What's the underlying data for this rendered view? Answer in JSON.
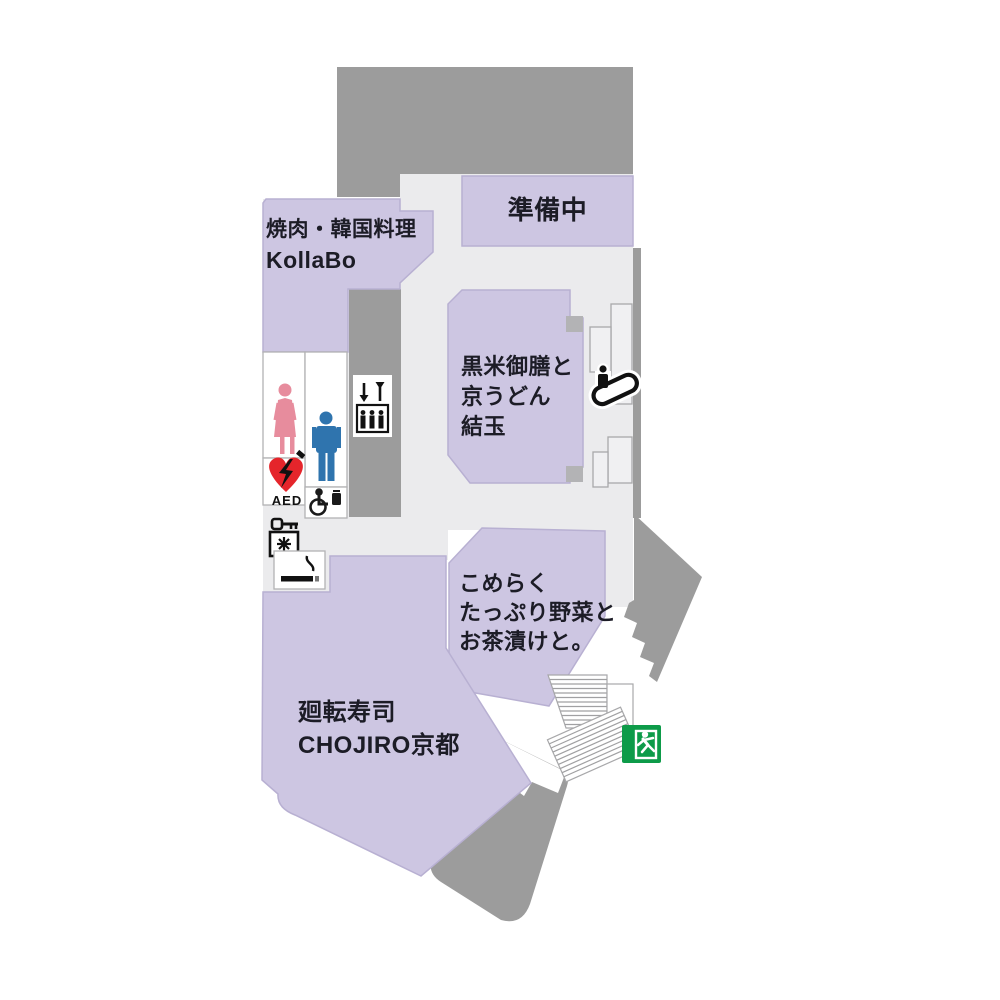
{
  "map": {
    "title": "restaurant-floor-map",
    "shops": {
      "kollabo": {
        "line1": "焼肉・韓国料理",
        "line2": "KollaBo"
      },
      "preparing": {
        "line1": "準備中"
      },
      "yuitama": {
        "line1": "黒米御膳と",
        "line2": "京うどん",
        "line3": "結玉"
      },
      "komeraku": {
        "line1": "こめらく",
        "line2": "たっぷり野菜と",
        "line3": "お茶漬けと。"
      },
      "chojiro": {
        "line1": "廻転寿司",
        "line2": "CHOJIRO京都"
      }
    },
    "facilities": {
      "aed_label": "AED",
      "icons": [
        "female-restroom-icon",
        "male-restroom-icon",
        "aed-icon",
        "accessible-restroom-icon",
        "coin-locker-icon",
        "smoking-area-icon",
        "elevator-icon",
        "escalator-icon",
        "stairs-icon",
        "emergency-exit-icon"
      ]
    },
    "colors": {
      "shop_fill": "#cdc6e2",
      "shop_border": "#b8b0d2",
      "wall_gray": "#9c9c9c",
      "floor_gray": "#ebebed",
      "aed_red": "#e5252b",
      "female_pink": "#e78c9d",
      "male_blue": "#2f74ae",
      "exit_green": "#0d9b49",
      "text_ink": "#1c1c26"
    }
  }
}
